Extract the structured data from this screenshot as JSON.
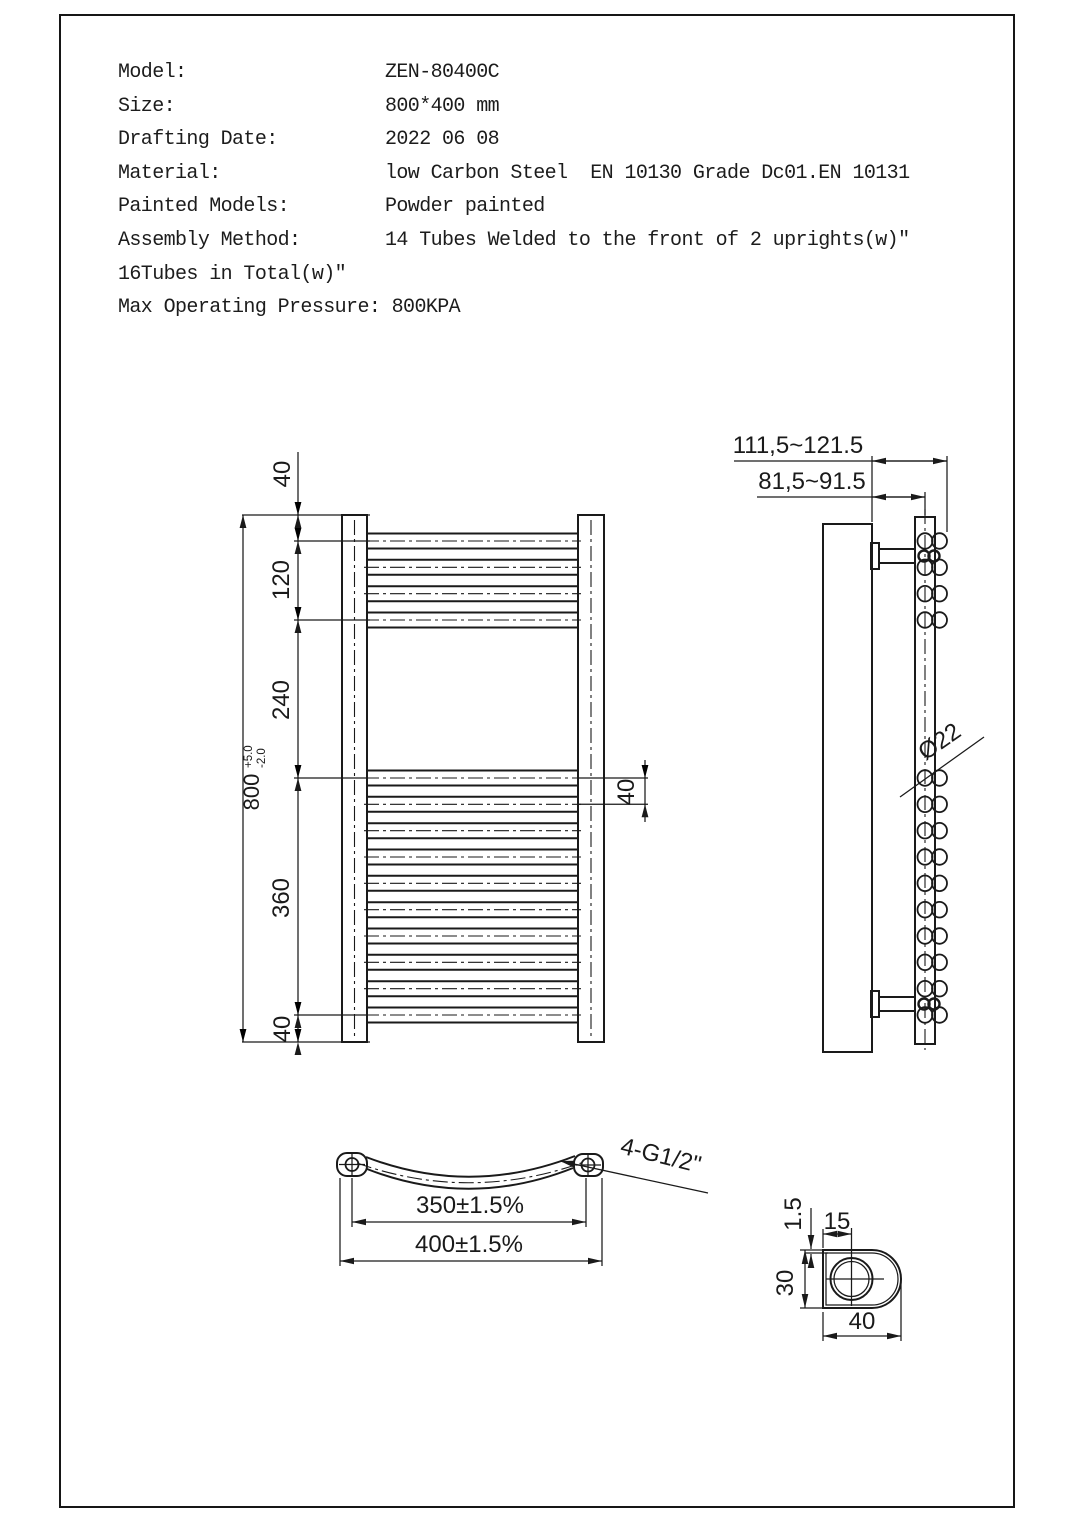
{
  "specs": {
    "rows": [
      {
        "label": "Model:",
        "value": "ZEN-80400C"
      },
      {
        "label": "Size:",
        "value": "800*400 mm"
      },
      {
        "label": "Drafting Date:",
        "value": "2022 06 08"
      },
      {
        "label": "Material:",
        "value": "low Carbon Steel  EN 10130 Grade Dc01.EN 10131"
      },
      {
        "label": "Painted Models:",
        "value": "Powder painted"
      },
      {
        "label": "Assembly Method:",
        "value": "14 Tubes Welded to the front of 2 uprights(w)\""
      }
    ],
    "note": "16Tubes in Total(w)\"",
    "max_pressure": "Max Operating Pressure: 800KPA"
  },
  "front_view": {
    "dims": {
      "top_margin": "40",
      "top_section": "120",
      "middle_gap": "240",
      "bottom_section": "360",
      "bottom_margin": "40",
      "tube_pitch": "40",
      "overall_height": "800",
      "tol_plus": "+5.0",
      "tol_minus": "-2.0"
    }
  },
  "side_view": {
    "dims": {
      "depth_max": "111,5~121.5",
      "depth_min": "81,5~91.5",
      "tube_diameter": "Ø22"
    }
  },
  "bottom_view": {
    "dims": {
      "centers": "350±1.5%",
      "overall_width": "400±1.5%",
      "connections": "4-G1/2\""
    }
  },
  "detail_view": {
    "dims": {
      "wall_thickness": "1.5",
      "hole_offset": "15",
      "profile_depth": "30",
      "profile_width": "40"
    }
  }
}
